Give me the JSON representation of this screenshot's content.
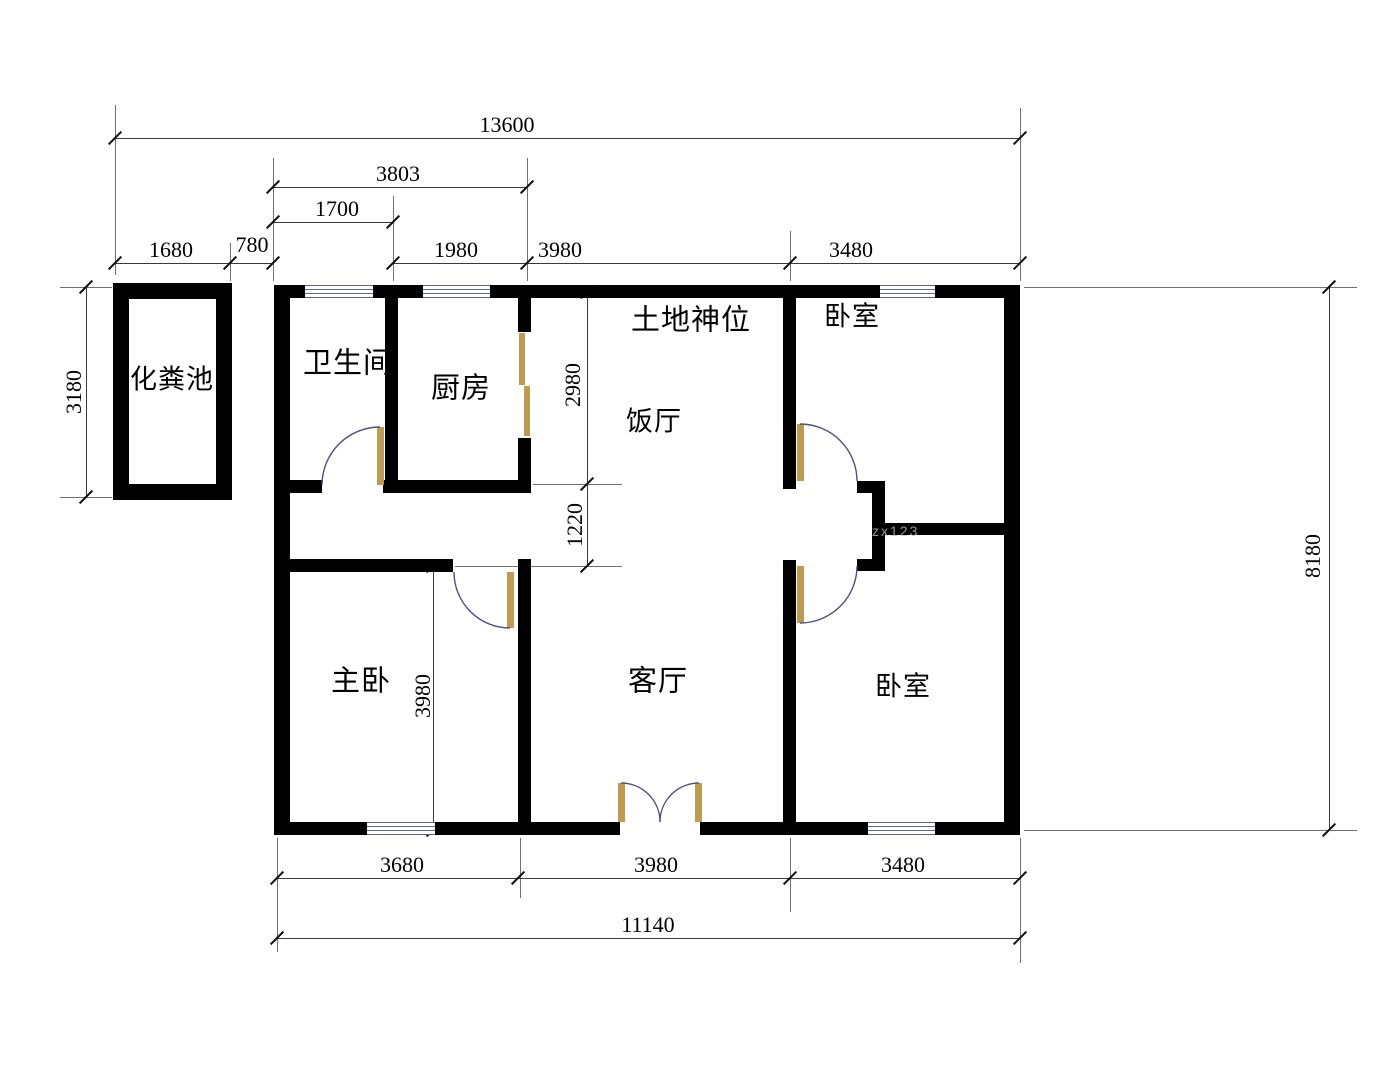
{
  "rooms": {
    "septic_tank": "化粪池",
    "bathroom": "卫生间",
    "kitchen": "厨房",
    "shrine": "土地神位",
    "dining": "饭厅",
    "bedroom_top_right": "卧室",
    "master_bedroom": "主卧",
    "living_room": "客厅",
    "bedroom_bottom_right": "卧室"
  },
  "dimensions": {
    "top_total": "13600",
    "top_3803": "3803",
    "top_1700": "1700",
    "top_1680": "1680",
    "top_780": "780",
    "top_1980": "1980",
    "top_3980": "3980",
    "top_3480": "3480",
    "left_3180": "3180",
    "mid_2980": "2980",
    "mid_1220": "1220",
    "right_8180": "8180",
    "master_3980": "3980",
    "bottom_3680": "3680",
    "bottom_3980": "3980",
    "bottom_3480": "3480",
    "bottom_total": "11140"
  },
  "watermark": "zx123",
  "colors": {
    "wall": "#000000",
    "door_leaf": "#BF9B4F",
    "door_arc": "#50507E",
    "window_line": "#5A6590",
    "dim_line": "#3a3a3a",
    "ext_line": "#707070",
    "text": "#000000"
  }
}
